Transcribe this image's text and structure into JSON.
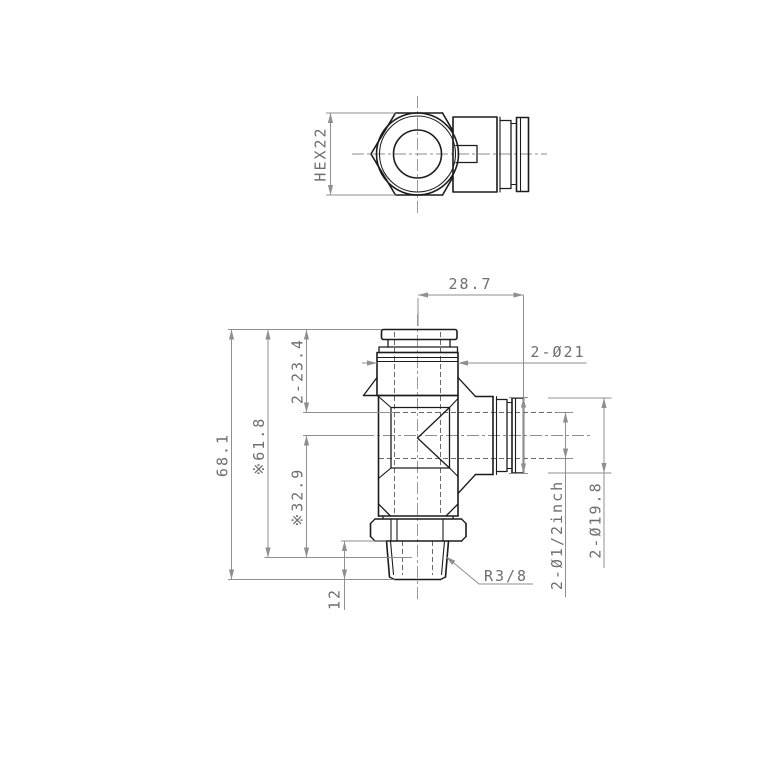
{
  "page": {
    "background": "#ffffff"
  },
  "colors": {
    "object_line": "#1c1c1c",
    "hidden_line": "#6a6a6a",
    "dimension_line": "#8f8f8f",
    "dimension_text": "#6e6e6e"
  },
  "drawing": {
    "view_count": 2,
    "views": [
      "top-view",
      "front-view"
    ]
  },
  "labels": {
    "hex_size": "HEX22",
    "branch_length": "28.7",
    "body_diameter": "2-Ø21",
    "overall_height": "68.1",
    "ref_height": "※61.8",
    "insert_depth": "2-23.4",
    "ref_branch_height": "※32.9",
    "thread_length": "12",
    "thread_spec": "R3/8",
    "tube_size": "2-Ø1/2inch",
    "collar_diameter": "2-Ø19.8"
  }
}
